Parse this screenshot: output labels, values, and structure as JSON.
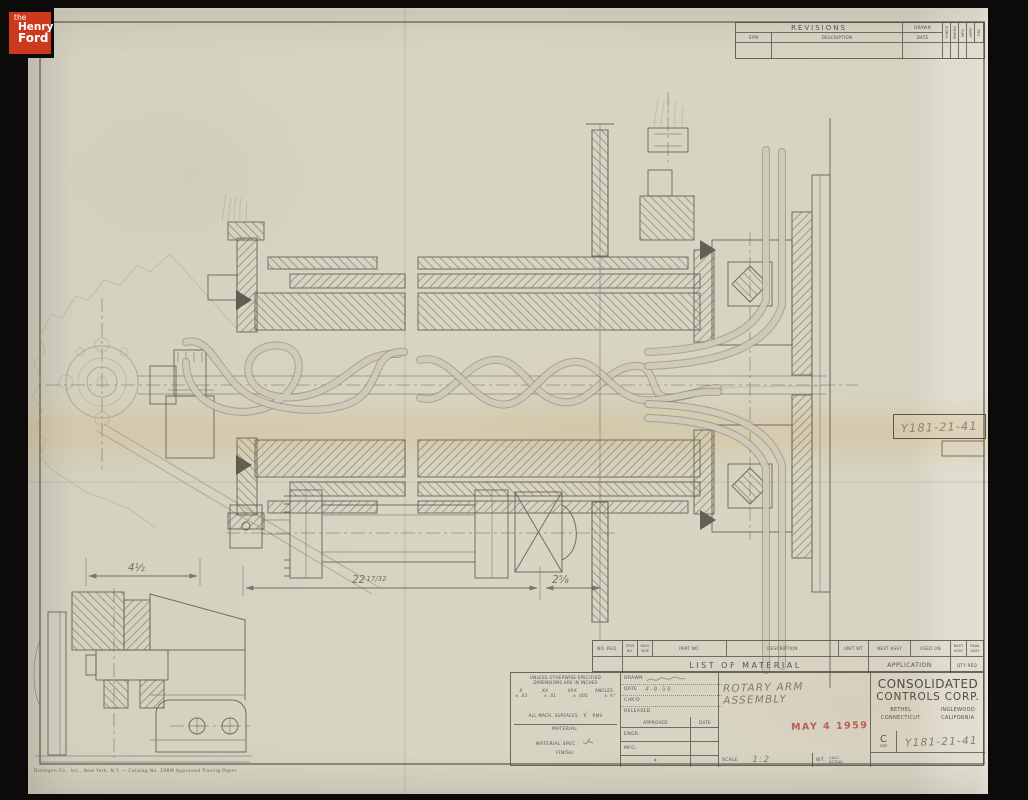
{
  "colors": {
    "logo_red": "#cc3a1d",
    "stamp_red": "#b5493f",
    "paper": "#d8d4c4",
    "ink": "#615d4f",
    "pencil": "#9d967f"
  },
  "logo": {
    "line1": "the",
    "line2": "Henry",
    "line3": "Ford"
  },
  "revisions": {
    "title": "REVISIONS",
    "sym": "SYM",
    "description": "DESCRIPTION",
    "drawn": "DRAWN",
    "date": "DATE",
    "vcols": [
      "CHECK",
      "ENGRG",
      "MFG",
      "APPD"
    ],
    "rel": "REL"
  },
  "ref_box": {
    "number": "Y181-21-41"
  },
  "dimensions": {
    "left": "4½",
    "main_whole": "22",
    "main_frac": "17/32",
    "right": "2⅝"
  },
  "lom": {
    "no_req": "NO. REQ.",
    "item_no": "ITEM NO.",
    "dwg_size": "DWG SIZE",
    "part_no": "PART NO.",
    "description": "DESCRIPTION",
    "unit_wt": "UNIT WT",
    "next_assy": "NEXT ASSY",
    "used_on": "USED ON",
    "next_assy_sm": "NEXT ASSY",
    "final_assy_sm": "FINAL ASSY",
    "band": "LIST OF MATERIAL",
    "application": "APPLICATION",
    "qty_req": "QTY REQ"
  },
  "tolerances": {
    "line1": "UNLESS OTHERWISE SPECIFIED",
    "line2": "DIMENSIONS ARE IN INCHES",
    "c1": ".X",
    "c2": ".XX",
    "c3": ".XXX",
    "c4": "ANGLES",
    "v1": "± .03",
    "v2": "± .01",
    "v3": "± .005",
    "v4": "± ½°",
    "surfaces": "ALL MACH. SURFACES",
    "check": "√",
    "rms": "RMS",
    "material": "MATERIAL:",
    "material_spec": "MATERIAL SPEC.",
    "finish": "FINISH:"
  },
  "title_block": {
    "drawn": "DRAWN",
    "date": "DATE",
    "date_value": "4-9-59",
    "chkd": "CHK'D.",
    "released": "RELEASED",
    "approved": "APPROVED",
    "approved_date": "DATE",
    "engr": "ENGR.",
    "mfg": "MFG.",
    "note": "*",
    "title": "ROTARY ARM ASSEMBLY",
    "scale": "SCALE",
    "scale_value": "1:2",
    "wt": "WT.",
    "wt_calc": "CALC.",
    "wt_actual": "ACTUAL",
    "stamp_date": "MAY 4 1959"
  },
  "company": {
    "name1": "CONSOLIDATED",
    "name2": "CONTROLS CORP.",
    "city1": "BETHEL",
    "state1": "CONNECTICUT",
    "city2": "INGLEWOOD",
    "state2": "CALIFORNIA",
    "size_letter": "C",
    "size_label": "SIZE",
    "drawing_number": "Y181-21-41"
  },
  "footer": {
    "credit": "Dietzgen Co., Inc., New York, N.Y. — Catalog No. 198M Approved Tracing Paper"
  }
}
